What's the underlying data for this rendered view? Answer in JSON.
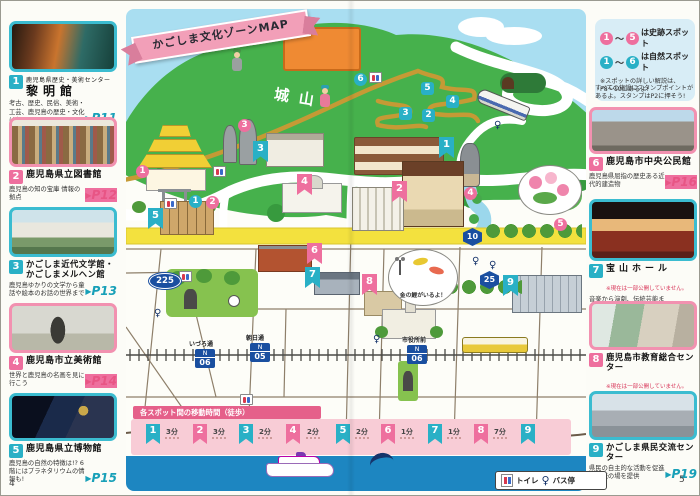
{
  "pages": {
    "left_number": "4",
    "right_number": "5"
  },
  "icons": {
    "page_arrow": "▶",
    "bus_pole": "♀"
  },
  "colors": {
    "teal": "#29b0c6",
    "pink": "#ee6f9e",
    "yellow_road": "#f3e13e",
    "hill_green": "#46b14c",
    "water_blue": "#1d86c1"
  },
  "map": {
    "title": "かごしま文化ゾーンMAP",
    "mountain_label": "城山",
    "koi_bubble": "金の鯉がいるよ！",
    "road_signs": {
      "r225": "225",
      "r10": "10",
      "r25": "25"
    },
    "tram_stops": [
      {
        "name": "いづろ通",
        "line": "N",
        "number": "06"
      },
      {
        "name": "朝日通",
        "line": "N",
        "number": "05"
      },
      {
        "name": "市役所前",
        "line": "N",
        "number": "06"
      }
    ],
    "facility_flags": [
      "1",
      "2",
      "3",
      "4",
      "5",
      "6",
      "7",
      "8",
      "9"
    ],
    "nature_badges": [
      "1",
      "2",
      "3",
      "4",
      "5",
      "6"
    ],
    "historic_badges": [
      "1",
      "2",
      "3",
      "4",
      "5"
    ]
  },
  "info_box": {
    "historic_line": {
      "from": "1",
      "to": "5",
      "text": "は史跡スポット"
    },
    "nature_line": {
      "from": "1",
      "to": "6",
      "text": "は自然スポット"
    },
    "range_separator": "〜",
    "note": "※スポットの詳しい解説は、P8〜10にあるよ!",
    "stamp_note": "すべての施設にスタンプポイントがあるよ。スタンプはP2に押そう!"
  },
  "facilities": [
    {
      "number": "1",
      "subtitle": "鹿児島県歴史・美術センター",
      "name": "黎明館",
      "note": "",
      "desc": "考古、歴史、民俗、美術・工芸、鹿児島の歴史・文化はおまかせ",
      "page": "P11"
    },
    {
      "number": "2",
      "subtitle": "",
      "name": "鹿児島県立図書館",
      "note": "",
      "desc": "鹿児島の知の宝庫 情報の拠点",
      "page": "P12"
    },
    {
      "number": "3",
      "subtitle": "",
      "name": "かごしま近代文学館・かごしまメルヘン館",
      "note": "",
      "desc": "鹿児島ゆかりの文学から童話や絵本のお話の世界まで",
      "page": "P13"
    },
    {
      "number": "4",
      "subtitle": "",
      "name": "鹿児島市立美術館",
      "note": "",
      "desc": "世界と鹿児島の名画を見に行こう",
      "page": "P14"
    },
    {
      "number": "5",
      "subtitle": "",
      "name": "鹿児島県立博物館",
      "note": "",
      "desc": "鹿児島の自然の特徴は!? 6階にはプラネタリウムの情報も!",
      "page": "P15"
    },
    {
      "number": "6",
      "subtitle": "",
      "name": "鹿児島市中央公民館",
      "note": "",
      "desc": "鹿児島県屈指の歴史ある近代的建造物",
      "page": "P16"
    },
    {
      "number": "7",
      "subtitle": "",
      "name": "宝山ホール",
      "note": "※現在は一部公開していません。",
      "desc": "音楽から演劇、伝統芸能まで、世界と鹿児島を舞台でつなぐ文化の殿堂",
      "page": "P17"
    },
    {
      "number": "8",
      "subtitle": "",
      "name": "鹿児島市教育総合センター",
      "note": "※現在は一部公開していません。",
      "desc": "青年のための、女性のための、さまざまな学びと体験をサポート",
      "page": "P18"
    },
    {
      "number": "9",
      "subtitle": "",
      "name": "かごしま県民交流センター",
      "note": "",
      "desc": "県民の自主的な活動を促進し交流の場を提供",
      "page": "P19"
    }
  ],
  "walk_strip": {
    "title": "各スポット間の移動時間（徒歩）",
    "stops": [
      "1",
      "2",
      "3",
      "4",
      "5",
      "6",
      "7",
      "8",
      "9"
    ],
    "times": [
      "3分",
      "3分",
      "2分",
      "2分",
      "2分",
      "1分",
      "1分",
      "7分"
    ]
  },
  "legend": {
    "toilet_label": "トイレ",
    "bus_label": "バス停"
  }
}
